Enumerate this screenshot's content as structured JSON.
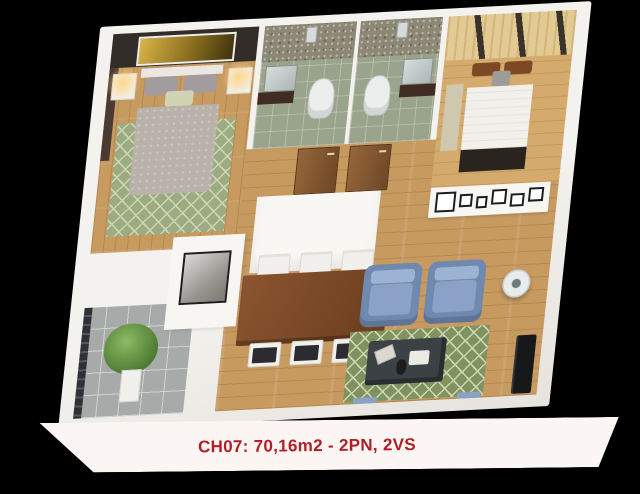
{
  "caption": {
    "text": "CH07: 70,16m2 - 2PN, 2VS"
  },
  "palette": {
    "bg": "#000000",
    "base": "#fbf6f4",
    "caption-red": "#b01f26",
    "wall": "#f4f2ee",
    "wall-deep": "#e6e3de",
    "wood": "#c79a60",
    "wood-light": "#d4ab6d",
    "headboard-dark": "#332d29",
    "gold-1": "#d9b44a",
    "gold-2": "#3f3110",
    "curtain-brown": "#4a3a31",
    "rug-sage": "#9cab81",
    "rug-green": "#7f9260",
    "rug-line": "#cdd6b2",
    "bed-gray": "#b9b2aa",
    "pillow-gray": "#a29c9f",
    "throw-green": "#d2d3b4",
    "bed-white": "#f2f0ea",
    "pillow-brown": "#7d4824",
    "foot-dark": "#2a241f",
    "wardrobe-wood": "#e2ca92",
    "wardrobe-stripe": "#3a332c",
    "mosaic": "#8d8876",
    "bath-floor": "#9aa48c",
    "mirror-1": "#d6dedd",
    "mirror-2": "#aab7b5",
    "vanity-dark": "#402c22",
    "porcelain": "#eceeee",
    "door-wood": "#96663a",
    "door-edge": "#6e4726",
    "table-wood": "#8a5530",
    "table-edge": "#6b3d1e",
    "chair-white": "#f1f0ec",
    "seat-dark": "#2b2b30",
    "sofa-blue": "#8ba2c6",
    "sofa-blue-deep": "#7089ae",
    "sofa-blue-light": "#9db3d4",
    "coffee-dark": "#3b4144",
    "tv-black": "#17181a",
    "tile-gray": "#a6abaa",
    "railing-dark": "#2e3237",
    "plant-green": "#8cba63",
    "plant-deep": "#4c7a33",
    "planter-white": "#f1f0ec",
    "frame-black": "#1d1d1f"
  }
}
